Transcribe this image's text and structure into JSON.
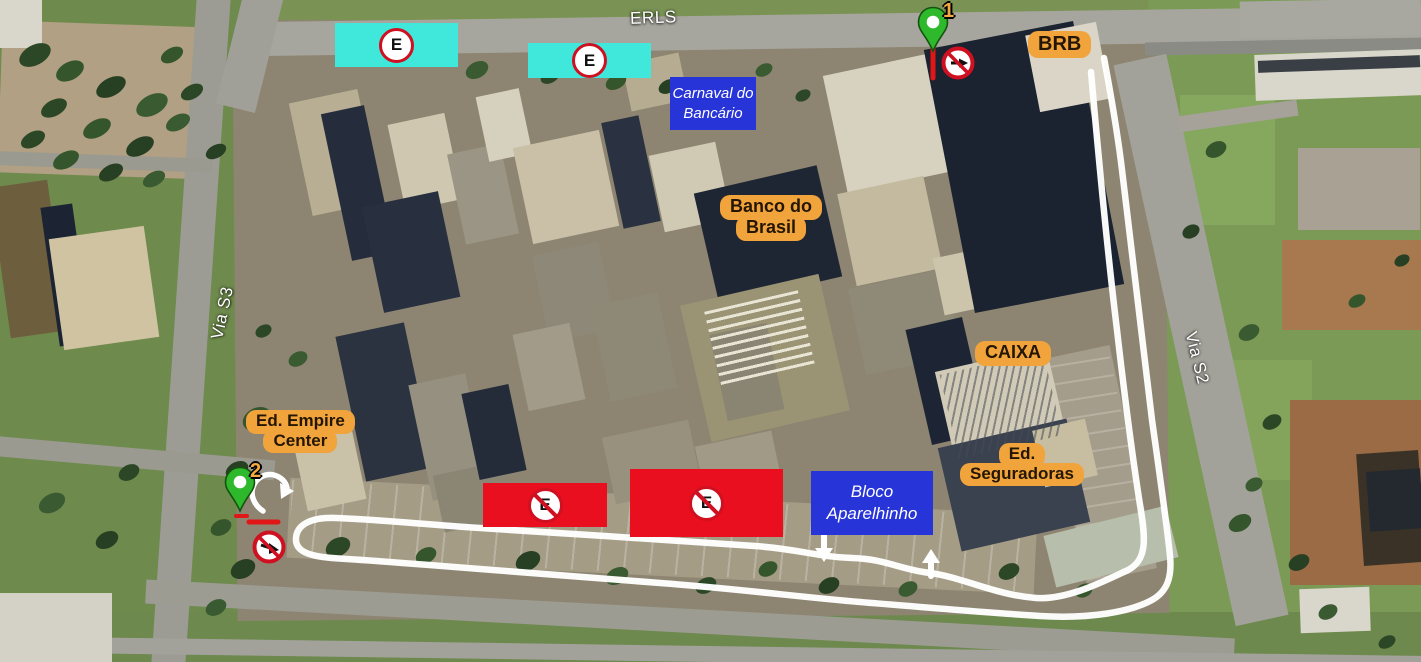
{
  "map": {
    "road_labels": [
      {
        "id": "erls",
        "text": "ERLS"
      },
      {
        "id": "via-s3",
        "text": "Via S3"
      },
      {
        "id": "via-s2",
        "text": "Via S2"
      }
    ],
    "building_labels": [
      {
        "id": "brb",
        "lines": [
          "BRB"
        ]
      },
      {
        "id": "banco-do-brasil",
        "lines": [
          "Banco do",
          "Brasil"
        ]
      },
      {
        "id": "caixa",
        "lines": [
          "CAIXA"
        ]
      },
      {
        "id": "ed-seguradoras",
        "lines": [
          "Ed.",
          "Seguradoras"
        ]
      },
      {
        "id": "ed-empire-center",
        "lines": [
          "Ed. Empire",
          "Center"
        ]
      }
    ],
    "event_labels": [
      {
        "id": "carnaval-do-bancario",
        "lines": [
          "Carnaval do",
          "Bancário"
        ]
      },
      {
        "id": "bloco-aparelhinho",
        "lines": [
          "Bloco",
          "Aparelhinho"
        ]
      }
    ],
    "pins": [
      {
        "id": "pin-1",
        "number": "1"
      },
      {
        "id": "pin-2",
        "number": "2"
      }
    ],
    "parking_zones": [
      {
        "id": "parking-allowed-1",
        "type": "parking-allowed",
        "symbol": "E"
      },
      {
        "id": "parking-allowed-2",
        "type": "parking-allowed",
        "symbol": "E"
      },
      {
        "id": "no-parking-1",
        "type": "no-parking",
        "symbol": "E"
      },
      {
        "id": "no-parking-2",
        "type": "no-parking",
        "symbol": "E"
      }
    ],
    "signs": [
      {
        "id": "no-entry-1",
        "type": "no-entry"
      },
      {
        "id": "no-entry-2",
        "type": "no-entry"
      },
      {
        "id": "u-turn-arrow",
        "type": "u-turn"
      },
      {
        "id": "arrow-down",
        "type": "movement-arrow"
      },
      {
        "id": "arrow-up",
        "type": "movement-arrow"
      }
    ]
  },
  "colors": {
    "label_orange": "#F1A43B",
    "label_blue": "#2734D8",
    "zone_cyan": "#3FE8DB",
    "zone_red": "#EA0F1F",
    "sign_red": "#CF1021",
    "pin_green": "#2EB82B",
    "route_white": "#FFFFFF"
  }
}
